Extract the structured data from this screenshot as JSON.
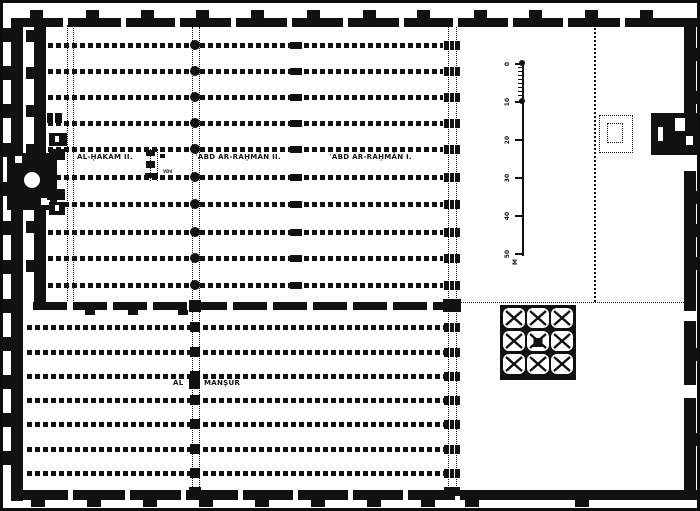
{
  "labels": {
    "al_hakam_ii": "AL-ḤAKAM II.",
    "abd_ar_rahman_ii": "ʿABD AR-RAḤMĀN II.",
    "abd_ar_rahman_i": "ʿABD AR-RAḤMĀN I.",
    "al_mansur": {
      "part1": "AL",
      "part2": "MANṢŪR"
    },
    "lantern_mark": "VDV"
  },
  "scale_bar": {
    "tick_labels": [
      "0",
      "10",
      "20",
      "30",
      "40",
      "50"
    ],
    "unit_label": "M"
  },
  "colors": {
    "ink": "#111111",
    "paper": "#ffffff"
  }
}
